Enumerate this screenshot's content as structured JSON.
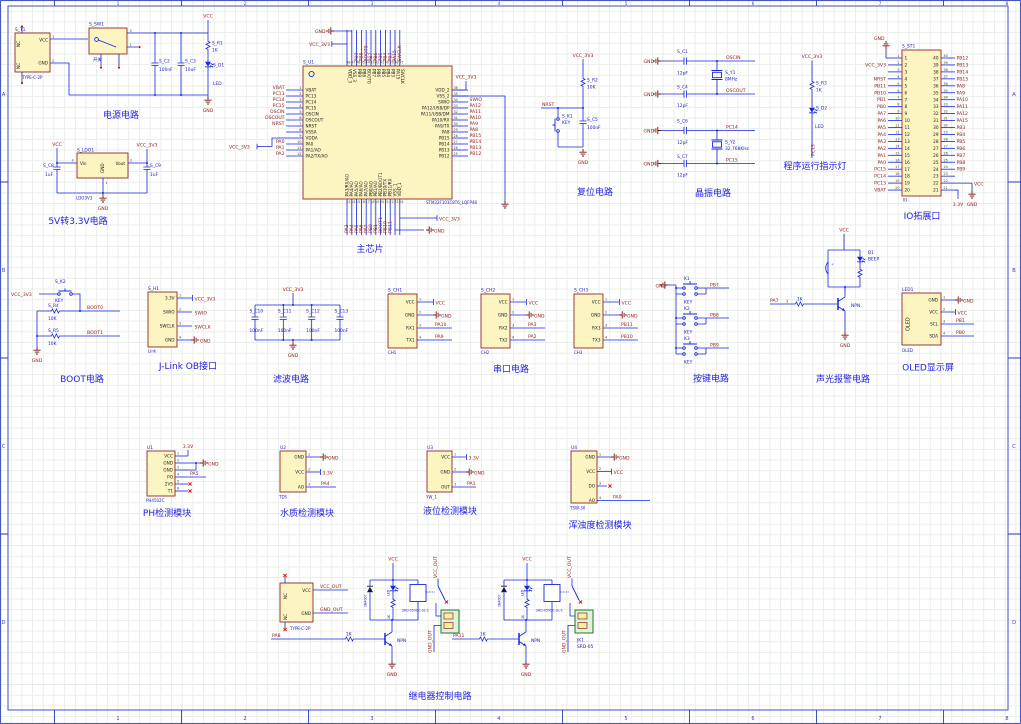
{
  "sheet": {
    "cols": [
      "1",
      "2",
      "3",
      "4",
      "5",
      "6",
      "7",
      "8"
    ],
    "rows": [
      "A",
      "B",
      "C",
      "D"
    ]
  },
  "power": {
    "title": "电源电路",
    "t1_des": "S_T1",
    "t1_part": "TYPE-C-2P",
    "t1_vcc": "VCC",
    "t1_gnd": "GND",
    "nc1": "NC",
    "nc2": "NC",
    "p1": "1",
    "p2": "2",
    "sw_des": "S_SW1",
    "sw_label": "开关",
    "sw_p3": "3",
    "sw_p1": "1",
    "c2_des": "S_C2",
    "c2_val": "100nF",
    "c3_des": "S_C3",
    "c3_val": "10uF",
    "r1_des": "S_R1",
    "r1_val": "1K",
    "d1_des": "S_D1",
    "d1_val": "LED",
    "vcc": "VCC",
    "gnd": "GND"
  },
  "ldo": {
    "title": "5V转3.3V电路",
    "des": "S_LDO1",
    "part": "LDO3V3",
    "vin": "Vin",
    "vout": "Vout",
    "gnd_pin": "GND",
    "p1": "1",
    "p2": "2",
    "p3": "3",
    "c8_des": "S_C8",
    "c8_val": "1uF",
    "c9_des": "S_C9",
    "c9_val": "1uF",
    "vcc": "VCC",
    "vcc3": "VCC_3V3",
    "gnd": "GND",
    "port": "VCC_3V3"
  },
  "chip": {
    "title": "主芯片",
    "des": "S_U1",
    "part": "STM32F103C8T6_LQFP48",
    "gnd": "GND",
    "vcc3": "VCC_3V3",
    "left": [
      {
        "n": "1",
        "name": "VBAT",
        "net": "VBAT"
      },
      {
        "n": "2",
        "name": "PC13",
        "net": "PC13"
      },
      {
        "n": "3",
        "name": "PC14",
        "net": "PC14"
      },
      {
        "n": "4",
        "name": "PC15",
        "net": "PC15"
      },
      {
        "n": "5",
        "name": "OSCIN",
        "net": "OSCIN"
      },
      {
        "n": "6",
        "name": "OSCOUT",
        "net": "OSCOUT"
      },
      {
        "n": "7",
        "name": "NRST",
        "net": "NRST"
      },
      {
        "n": "8",
        "name": "VSSA",
        "net": ""
      },
      {
        "n": "9",
        "name": "VDDA",
        "net": ""
      },
      {
        "n": "10",
        "name": "PA0",
        "net": "PA0"
      },
      {
        "n": "11",
        "name": "PA1/AO",
        "net": "PA1"
      },
      {
        "n": "12",
        "name": "PA2/TX/AO",
        "net": "PA2"
      }
    ],
    "right": [
      {
        "n": "36",
        "name": "VDD_2",
        "net": ""
      },
      {
        "n": "35",
        "name": "VSS_2",
        "net": ""
      },
      {
        "n": "34",
        "name": "SWIO",
        "net": "SWIO"
      },
      {
        "n": "33",
        "name": "PA12/USB/DP",
        "net": "PA12"
      },
      {
        "n": "32",
        "name": "PA11/USB/DM",
        "net": "PA11"
      },
      {
        "n": "31",
        "name": "PA10/RX",
        "net": "PA10"
      },
      {
        "n": "30",
        "name": "PA9/TX",
        "net": "PA9"
      },
      {
        "n": "29",
        "name": "PA8",
        "net": "PA8"
      },
      {
        "n": "28",
        "name": "PB15",
        "net": "PB15"
      },
      {
        "n": "27",
        "name": "PB14",
        "net": "PB14"
      },
      {
        "n": "26",
        "name": "PB13",
        "net": "PB13"
      },
      {
        "n": "25",
        "name": "PB12",
        "net": "PB12"
      }
    ],
    "top": [
      {
        "n": "48",
        "name": "VDD_3",
        "net": ""
      },
      {
        "n": "47",
        "name": "VSS_3",
        "net": ""
      },
      {
        "n": "46",
        "name": "PB9",
        "net": "PB9"
      },
      {
        "n": "45",
        "name": "PB8",
        "net": "PB8"
      },
      {
        "n": "44",
        "name": "BOOT0",
        "net": "BOOT0"
      },
      {
        "n": "43",
        "name": "PB7",
        "net": "PB7"
      },
      {
        "n": "42",
        "name": "PB6",
        "net": "PB6"
      },
      {
        "n": "41",
        "name": "PB5",
        "net": "PB5"
      },
      {
        "n": "40",
        "name": "PB4",
        "net": "PB4"
      },
      {
        "n": "39",
        "name": "PB3",
        "net": "PB3"
      },
      {
        "n": "38",
        "name": "PA15",
        "net": "PA15"
      },
      {
        "n": "37",
        "name": "SWCLK",
        "net": "SWCLK"
      }
    ],
    "bottom": [
      {
        "n": "13",
        "name": "PA3/RX/AO",
        "net": "PA3"
      },
      {
        "n": "14",
        "name": "PA4/AO",
        "net": "PA4"
      },
      {
        "n": "15",
        "name": "PA5/AO",
        "net": "PA5"
      },
      {
        "n": "16",
        "name": "PA6/AO",
        "net": "PA6"
      },
      {
        "n": "17",
        "name": "PA7/AO",
        "net": "PA7"
      },
      {
        "n": "18",
        "name": "PB0/AO",
        "net": "PB0"
      },
      {
        "n": "19",
        "name": "PB1/AO",
        "net": "PB1"
      },
      {
        "n": "20",
        "name": "PB2/BOOT1",
        "net": "BOOT1"
      },
      {
        "n": "21",
        "name": "PB10/TX",
        "net": "PB10"
      },
      {
        "n": "22",
        "name": "PB11/RX",
        "net": "PB11"
      },
      {
        "n": "23",
        "name": "VSS_1",
        "net": ""
      },
      {
        "n": "24",
        "name": "VDD_1",
        "net": ""
      }
    ]
  },
  "reset": {
    "title": "复位电路",
    "vcc3": "VCC_3V3",
    "r_des": "S_R2",
    "r_val": "10K",
    "net": "NRST",
    "k_des": "S_K1",
    "k_val": "KEY",
    "c_des": "S_C5",
    "c_val": "100nF",
    "gnd": "GND"
  },
  "xtal": {
    "title": "晶振电路",
    "rows": [
      {
        "g": "GND",
        "cu": "S_C1",
        "cuv": "12pF",
        "cl": "S_C4",
        "clv": "12pF",
        "ydes": "S_Y1",
        "yval": "8MHz",
        "ntop": "OSCIN",
        "nbot": "OSCOUT"
      },
      {
        "g": "GND",
        "cu": "S_C6",
        "cuv": "12pF",
        "cl": "S_C7",
        "clv": "12pF",
        "ydes": "S_Y2",
        "yval": "32.768KHz",
        "ntop": "PC14",
        "nbot": "PC15"
      }
    ]
  },
  "runled": {
    "title": "程序运行指示灯",
    "vcc3": "VCC_3V3",
    "r_des": "S_R3",
    "r_val": "1K",
    "d_des": "S_D2",
    "d_val": "LED",
    "net": "PC13"
  },
  "io": {
    "title": "IO拓展口",
    "des": "S_ST1",
    "part": "IO",
    "gnd_top": "GND",
    "vcc": "VCC",
    "gnd_br": "GND",
    "v33": "3.3V",
    "left": [
      {
        "n": "1",
        "net": ""
      },
      {
        "n": "2",
        "net": "VCC_3V3"
      },
      {
        "n": "3",
        "net": ""
      },
      {
        "n": "4",
        "net": "NRST"
      },
      {
        "n": "5",
        "net": "PB11"
      },
      {
        "n": "6",
        "net": "PB10"
      },
      {
        "n": "7",
        "net": "PB1"
      },
      {
        "n": "8",
        "net": "PB0"
      },
      {
        "n": "9",
        "net": "PA7"
      },
      {
        "n": "10",
        "net": "PA6"
      },
      {
        "n": "11",
        "net": "PA5"
      },
      {
        "n": "12",
        "net": "PA4"
      },
      {
        "n": "13",
        "net": "PA3"
      },
      {
        "n": "14",
        "net": "PA2"
      },
      {
        "n": "15",
        "net": "PA1"
      },
      {
        "n": "16",
        "net": "PA0"
      },
      {
        "n": "17",
        "net": "PC15"
      },
      {
        "n": "18",
        "net": "PC14"
      },
      {
        "n": "19",
        "net": "PC13"
      },
      {
        "n": "20",
        "net": "VBAT"
      }
    ],
    "right": [
      {
        "n": "40",
        "net": "PB12"
      },
      {
        "n": "39",
        "net": "PB13"
      },
      {
        "n": "38",
        "net": "PB14"
      },
      {
        "n": "37",
        "net": "PB15"
      },
      {
        "n": "36",
        "net": "PA8"
      },
      {
        "n": "35",
        "net": "PA9"
      },
      {
        "n": "34",
        "net": "PA10"
      },
      {
        "n": "33",
        "net": "PA11"
      },
      {
        "n": "32",
        "net": "PA12"
      },
      {
        "n": "31",
        "net": "PA15"
      },
      {
        "n": "30",
        "net": "PB3"
      },
      {
        "n": "29",
        "net": "PB4"
      },
      {
        "n": "28",
        "net": "PB5"
      },
      {
        "n": "27",
        "net": "PB6"
      },
      {
        "n": "26",
        "net": "PB7"
      },
      {
        "n": "25",
        "net": "PB8"
      },
      {
        "n": "24",
        "net": "PB9"
      },
      {
        "n": "23",
        "net": ""
      },
      {
        "n": "22",
        "net": ""
      },
      {
        "n": "21",
        "net": ""
      }
    ]
  },
  "boot": {
    "title": "BOOT电路",
    "vcc3": "VCC_3V3",
    "k_des": "S_K2",
    "k_val": "KEY",
    "r4_des": "S_R4",
    "r4_val": "10K",
    "net0": "BOOT0",
    "r5_des": "S_R5",
    "r5_val": "10K",
    "net1": "BOOT1",
    "gnd": "GND"
  },
  "jlink": {
    "title": "J-Link OB接口",
    "des": "S_H1",
    "part": "Link",
    "p1": "3.3V",
    "p2": "SWIO",
    "p3": "SWCLK",
    "p4": "GND",
    "n1": "1",
    "n2": "2",
    "n3": "3",
    "n4": "4",
    "t1": "VCC_3V3",
    "t2": "SWIO",
    "t3": "SWCLK",
    "t4": "GND"
  },
  "filter": {
    "title": "滤波电路",
    "vcc3": "VCC_3V3",
    "gnd": "GND",
    "caps": [
      {
        "des": "S_C10",
        "val": "100nF"
      },
      {
        "des": "S_C11",
        "val": "100nF"
      },
      {
        "des": "S_C12",
        "val": "100nF"
      },
      {
        "des": "S_C13",
        "val": "100nF"
      }
    ]
  },
  "serial": {
    "title": "串口电路",
    "units": [
      {
        "des": "S_CH1",
        "sub": "CH1",
        "p1": "VCC",
        "p2": "GND",
        "p3": "RX1",
        "p4": "TX1",
        "q1": "1",
        "q2": "2",
        "q3": "3",
        "q4": "4",
        "n1": "VCC",
        "n2": "GND",
        "n3": "PA10",
        "n4": "PA9"
      },
      {
        "des": "S_CH2",
        "sub": "CH2",
        "p1": "VCC",
        "p2": "GND",
        "p3": "RX2",
        "p4": "TX2",
        "q1": "1",
        "q2": "2",
        "q3": "3",
        "q4": "4",
        "n1": "VCC",
        "n2": "GND",
        "n3": "PA3",
        "n4": "PA2"
      },
      {
        "des": "S_CH3",
        "sub": "CH3",
        "p1": "VCC",
        "p2": "GND",
        "p3": "RX3",
        "p4": "TX3",
        "q1": "1",
        "q2": "2",
        "q3": "3",
        "q4": "4",
        "n1": "VCC",
        "n2": "GND",
        "n3": "PB11",
        "n4": "PB10"
      }
    ]
  },
  "keys": {
    "title": "按键电路",
    "gnd": "GND",
    "items": [
      {
        "des": "K1",
        "val": "KEY",
        "net": "PB7"
      },
      {
        "des": "K2",
        "val": "KEY",
        "net": "PB8"
      },
      {
        "des": "K3",
        "val": "KEY",
        "net": "PB9"
      }
    ]
  },
  "alarm": {
    "title": "声光报警电路",
    "vcc": "VCC",
    "gnd": "GND",
    "b_des": "B1",
    "b_val": "BEEP",
    "npn": "NPN",
    "rb": "1K",
    "net": "PA7",
    "pin3": "3"
  },
  "oled": {
    "title": "OLED显示屏",
    "des": "LED1",
    "part": "OLED",
    "inner": "OLED",
    "p1": "GND",
    "p2": "VCC",
    "p3": "SCL",
    "p4": "SDA",
    "n1": "1",
    "n2": "2",
    "n3": "3",
    "n4": "4",
    "t1": "GND",
    "t2": "VCC",
    "t3": "PB1",
    "t4": "PB0"
  },
  "ph": {
    "title": "PH检测模块",
    "des": "U1",
    "part": "PH4502C",
    "net_top": "3.3V",
    "gnd": "GND",
    "net_po": "PA5",
    "pins": [
      {
        "n": "1",
        "name": "VCC"
      },
      {
        "n": "2",
        "name": "GND"
      },
      {
        "n": "3",
        "name": "GND"
      },
      {
        "n": "4",
        "name": "PO"
      },
      {
        "n": "5",
        "name": "2V5"
      },
      {
        "n": "6",
        "name": "T1"
      }
    ]
  },
  "tds": {
    "title": "水质检测模块",
    "des": "U2",
    "part": "TDS",
    "p1": "GND",
    "p2": "VCC",
    "p3": "AO",
    "n1": "1",
    "n2": "2",
    "n3": "3",
    "t1": "GND",
    "t2": "3.3V",
    "t3": "PA4"
  },
  "level": {
    "title": "液位检测模块",
    "des": "U3",
    "part": "YW_1",
    "p1": "VCC",
    "p2": "GND",
    "p3": "OUT",
    "n1": "1",
    "n2": "2",
    "n3": "3",
    "t1": "3.3V",
    "t2": "GND",
    "t3": "PA1"
  },
  "turb": {
    "title": "浑浊度检测模块",
    "des": "U4",
    "part": "TSW-30",
    "p1": "GND",
    "p2": "VCC",
    "p3": "DO",
    "p4": "AO",
    "n1": "1",
    "n2": "2",
    "n3": "3",
    "n4": "4",
    "t1": "GND",
    "t2": "VCC",
    "t4": "PA0"
  },
  "relay": {
    "title": "继电器控制电路",
    "conn": {
      "part": "TYPE-C-2P",
      "vcc": "VCC",
      "gnd": "GND",
      "nc1": "NC",
      "nc2": "NC",
      "net_v": "VCC_OUT",
      "net_g": "GND_OUT"
    },
    "u1": {
      "vcc": "VCC",
      "gnd": "GND",
      "dio": "1N4007",
      "led": "LED",
      "r1": "1K",
      "rb": "1K",
      "net": "PA8",
      "npn": "NPN",
      "coil": "SRD-05VDC-SL-C",
      "nv": "VCC_OUT",
      "ng": "GND_OUT"
    },
    "u2": {
      "vcc": "VCC",
      "gnd": "GND",
      "dio": "1N4007",
      "led": "LED",
      "r1": "1K",
      "rb": "1K",
      "net": "PA11",
      "npn": "NPN",
      "coil": "SRD-05VDC-SL-C",
      "nv": "VCC_OUT",
      "ng": "GND_OUT",
      "jk_des": "JK1",
      "jk_part": "SRD-05"
    }
  }
}
